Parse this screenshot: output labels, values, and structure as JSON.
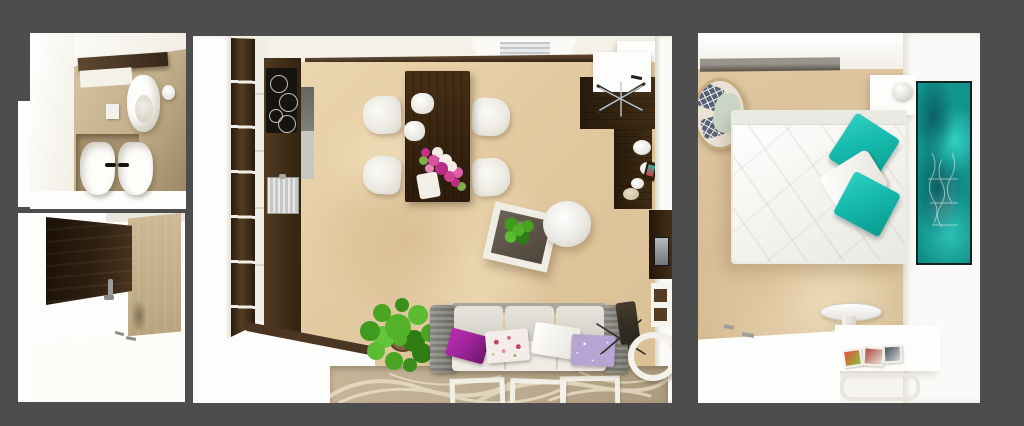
{
  "scene": {
    "description": "Photorealistic top-down 3D render of a small apartment presented as three separate view panels on a dark gray backdrop; no text or UI controls are visible",
    "background": "#4d4d4d",
    "panels": [
      {
        "id": "bathroom-top-view",
        "contents": [
          "wood-shelf",
          "toilet",
          "paper-roll",
          "flush-plate",
          "double-sink-with-black-faucets"
        ]
      },
      {
        "id": "kitchen-hallway-perspective",
        "contents": [
          "dark-wood-wall-panel",
          "stone-wall",
          "faucet",
          "white-counter"
        ]
      },
      {
        "id": "living-room-top-view",
        "contents": [
          "wardrobe-column",
          "kitchen-counter",
          "cooktop",
          "sink",
          "window-with-blinds",
          "dining-table",
          "four-chairs",
          "pendant-lamps",
          "flower-bouquet",
          "desk",
          "office-chair",
          "plates",
          "tv-niche",
          "coffee-table-with-plant",
          "round-side-table",
          "sofa-with-pillows",
          "floor-plant",
          "swirl-rug-with-white-frames",
          "leaning-clock"
        ]
      },
      {
        "id": "bedroom-top-view",
        "contents": [
          "gray-ledge",
          "pillow-basket",
          "double-bed",
          "teal-pillows",
          "white-pillow",
          "nightstand-with-lamp",
          "ocean-artwork",
          "round-stool",
          "desk-with-photos",
          "chair",
          "white-counter"
        ]
      }
    ],
    "colors": {
      "bg": "#4d4d4d",
      "white": "#fdfdfb",
      "ivory": "#f5f2ec",
      "floorbeige": "#e2c89f",
      "stainlight": "#f0ddbb",
      "staindark": "#d2b286",
      "bathwall": "#d3c1a0",
      "bathdark": "#9c8765",
      "niche": "#a5906e",
      "wooddark": "#4a3623",
      "wooddeep": "#2a1b0c",
      "woodmid": "#543d24",
      "cooktop": "#17130e",
      "steel": "#c6c6c4",
      "glassdark": "#63665f",
      "glasslight": "#c9c7c2",
      "teal": "#16bcae",
      "tealdeep": "#0b9a8f",
      "artteal": "#13968f",
      "artbright": "#32cfc2",
      "artdark": "#0a6165",
      "purple": "#a1249c",
      "purpledeep": "#6f166f",
      "lavender": "#b6a4d2",
      "floralbase": "#f4ece9",
      "floralred": "#c64460",
      "sofaarm": "#807e78",
      "sofaback": "#dfddd5",
      "sofaseat": "#eeece5",
      "rugbase": "#bcab8f",
      "rugswirl": "#eadfc8",
      "rugwhite": "#f3f0e7",
      "plantgreen": "#52b02a",
      "plantdark": "#2f7d14",
      "ledge": "#8e897f",
      "ledgedark": "#575147",
      "blind": "#c4c8ca",
      "navy": "#596275",
      "sage": "#ccd6c7",
      "basket": "#c6ab80",
      "chrome": "#c4c7c9",
      "wire": "#2b2b28"
    }
  }
}
